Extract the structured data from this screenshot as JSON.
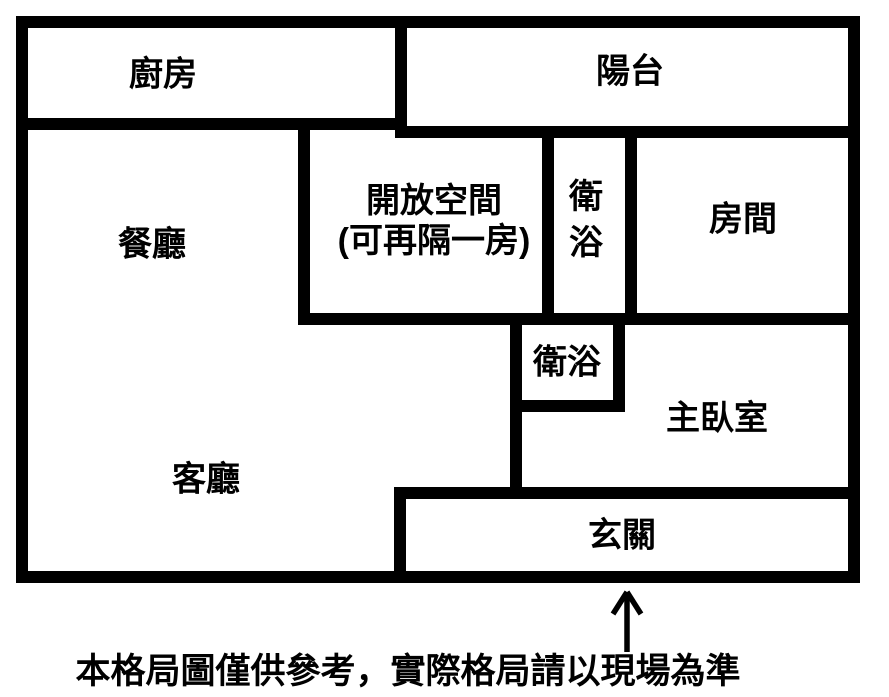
{
  "colors": {
    "wall": "#000000",
    "background": "#ffffff",
    "text": "#000000"
  },
  "rooms": {
    "kitchen": "廚房",
    "balcony": "陽台",
    "dining": "餐廳",
    "open_space_line1": "開放空間",
    "open_space_line2": "(可再隔一房)",
    "bath_upper": "衛浴",
    "room": "房間",
    "bath_lower": "衛浴",
    "master_bedroom": "主臥室",
    "living_room": "客廳",
    "entrance": "玄關"
  },
  "annotations": {
    "disclaimer": "本格局圖僅供參考，實際格局請以現場為準",
    "entrance_arrow": "up-arrow"
  }
}
